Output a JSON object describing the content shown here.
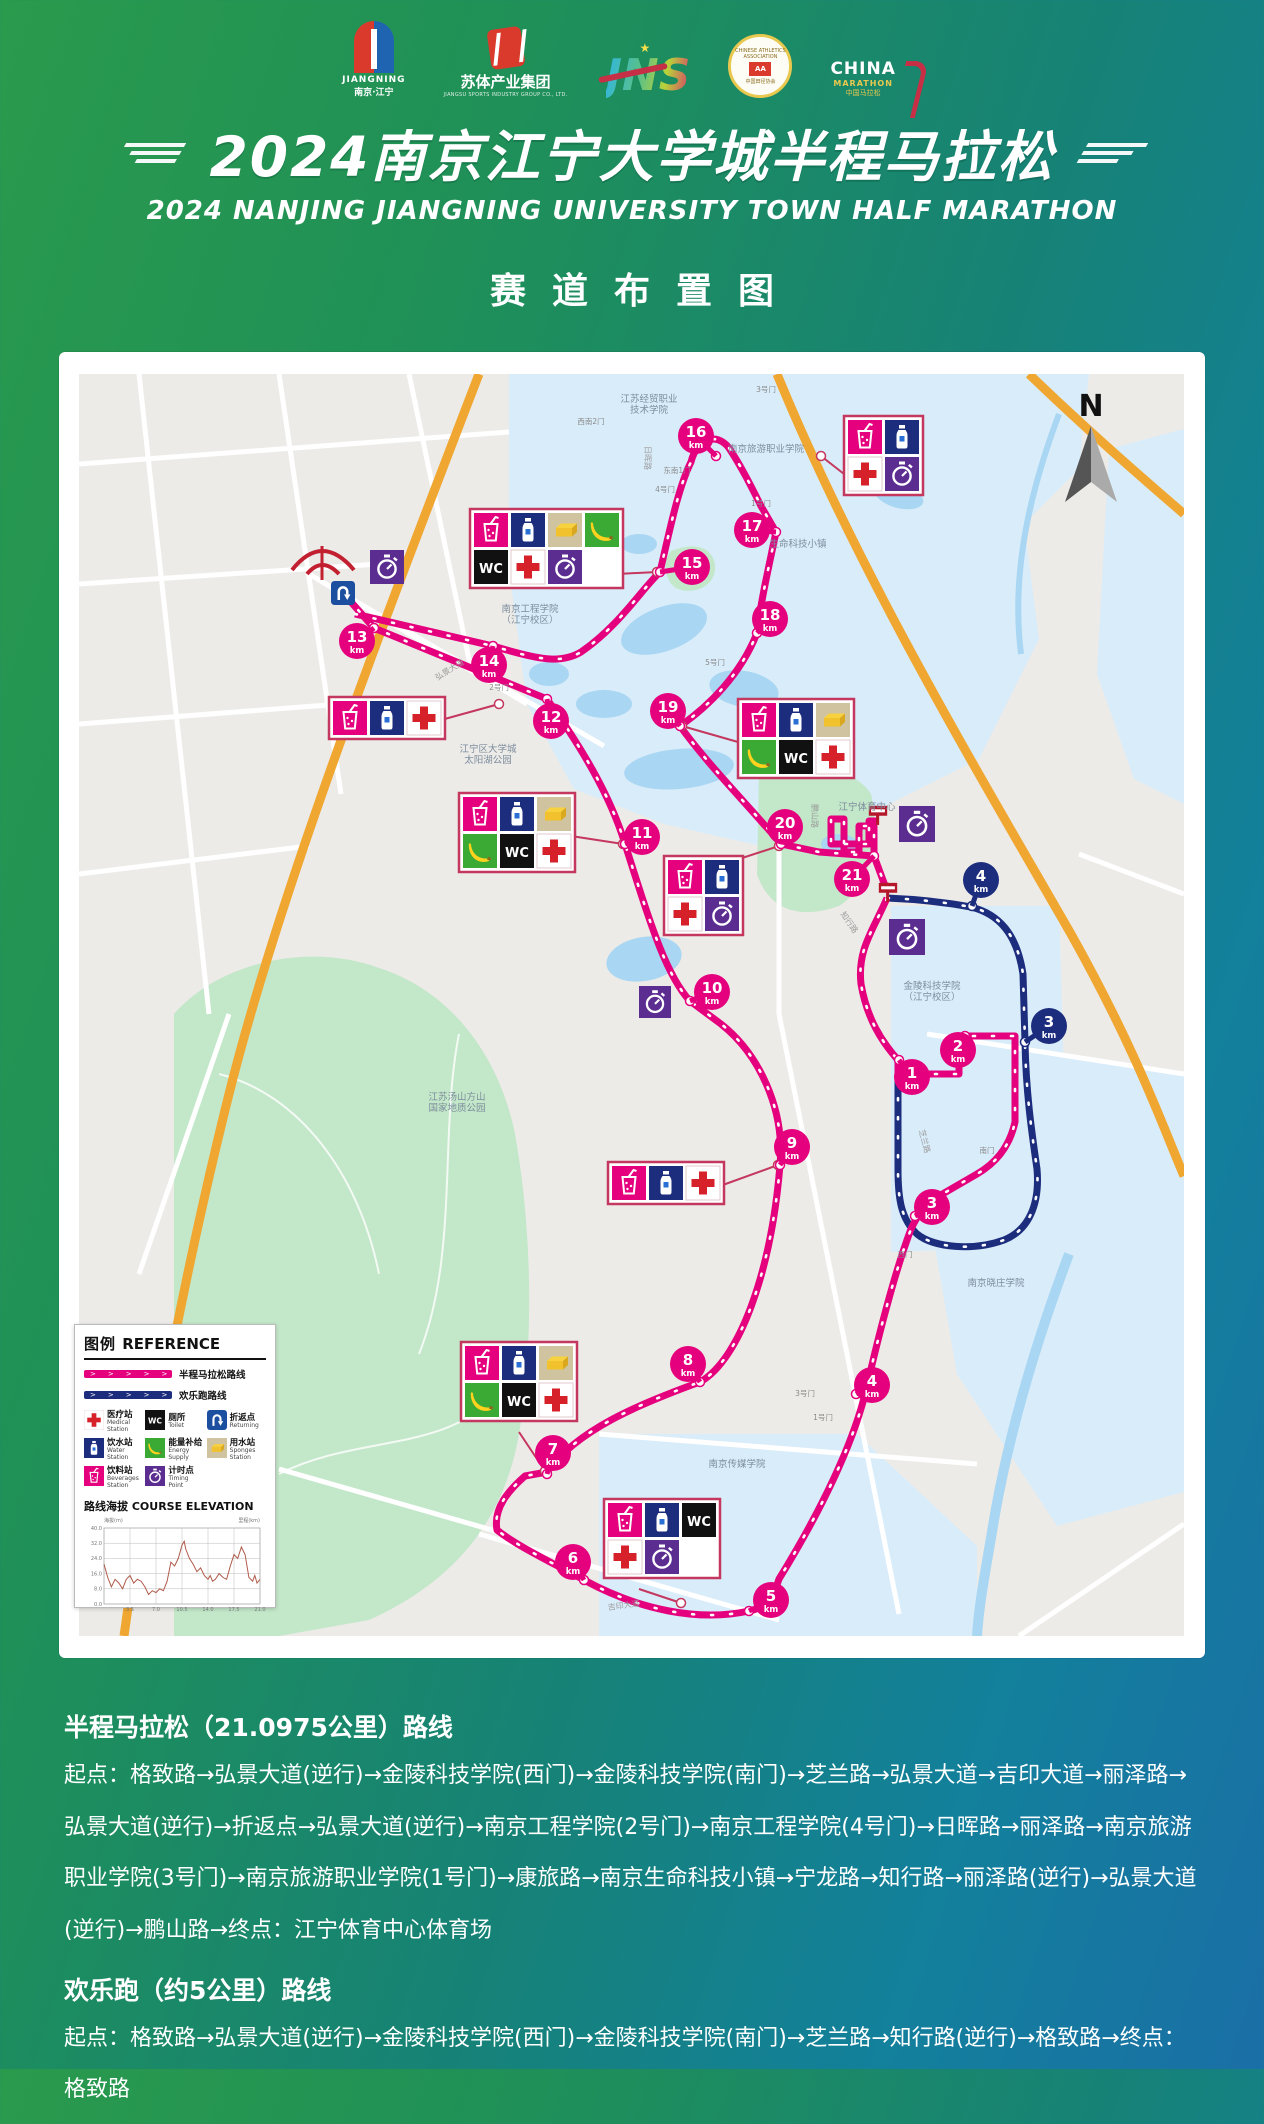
{
  "header": {
    "logos": {
      "jiangning": {
        "en": "JIANGNING",
        "zh": "南京·江宁"
      },
      "sutí": {
        "name": "苏体产业集团",
        "sub": "JIANGSU SPORTS INDUSTRY GROUP CO., LTD."
      },
      "jns": {
        "name": "JNS"
      },
      "caa": {
        "ring_top": "CHINESE ATHLETICS ASSOCIATION",
        "center": "AA",
        "ring_bottom": "中国田径协会"
      },
      "china_marathon": {
        "l1": "CHINA",
        "l2": "MARATHON",
        "l3": "中国马拉松"
      }
    },
    "title_zh": "2024南京江宁大学城半程马拉松",
    "title_en": "2024 NANJING JIANGNING UNIVERSITY TOWN HALF MARATHON",
    "subtitle": "赛道布置图"
  },
  "map": {
    "north": "N",
    "colors": {
      "half": "#e5017d",
      "fun": "#1d2d7d",
      "park": "#c3e7c9",
      "water": "#a9d6f2",
      "campus": "#d9ecfa",
      "road": "#f0a732",
      "base": "#ecebe8"
    },
    "km_markers": [
      {
        "n": "1",
        "km": "km",
        "c": "p",
        "x": 833,
        "y": 703,
        "dx": 820,
        "dy": 686
      },
      {
        "n": "2",
        "km": "km",
        "c": "p",
        "x": 879,
        "y": 676,
        "dx": 886,
        "dy": 662
      },
      {
        "n": "3",
        "km": "km",
        "c": "n",
        "x": 970,
        "y": 652,
        "dx": 946,
        "dy": 668
      },
      {
        "n": "4",
        "km": "km",
        "c": "n",
        "x": 902,
        "y": 506,
        "dx": 893,
        "dy": 532
      },
      {
        "n": "3",
        "km": "km",
        "c": "p",
        "x": 853,
        "y": 833,
        "dx": 836,
        "dy": 842
      },
      {
        "n": "4",
        "km": "km",
        "c": "p",
        "x": 793,
        "y": 1011,
        "dx": 777,
        "dy": 1020
      },
      {
        "n": "5",
        "km": "km",
        "c": "p",
        "x": 692,
        "y": 1226,
        "dx": 670,
        "dy": 1237
      },
      {
        "n": "6",
        "km": "km",
        "c": "p",
        "x": 494,
        "y": 1188,
        "dx": 505,
        "dy": 1206
      },
      {
        "n": "7",
        "km": "km",
        "c": "p",
        "x": 474,
        "y": 1079,
        "dx": 468,
        "dy": 1100
      },
      {
        "n": "8",
        "km": "km",
        "c": "p",
        "x": 609,
        "y": 990,
        "dx": 621,
        "dy": 1008
      },
      {
        "n": "9",
        "km": "km",
        "c": "p",
        "x": 713,
        "y": 773,
        "dx": 701,
        "dy": 791
      },
      {
        "n": "10",
        "km": "km",
        "c": "p",
        "x": 633,
        "y": 618,
        "dx": 611,
        "dy": 627
      },
      {
        "n": "11",
        "km": "km",
        "c": "p",
        "x": 563,
        "y": 463,
        "dx": 546,
        "dy": 470
      },
      {
        "n": "12",
        "km": "km",
        "c": "p",
        "x": 472,
        "y": 347,
        "dx": 468,
        "dy": 325
      },
      {
        "n": "13",
        "km": "km",
        "c": "p",
        "x": 278,
        "y": 267,
        "dx": 295,
        "dy": 254
      },
      {
        "n": "14",
        "km": "km",
        "c": "p",
        "x": 410,
        "y": 291,
        "dx": 414,
        "dy": 272
      },
      {
        "n": "15",
        "km": "km",
        "c": "p",
        "x": 613,
        "y": 193,
        "dx": 581,
        "dy": 198
      },
      {
        "n": "16",
        "km": "km",
        "c": "p",
        "x": 617,
        "y": 62,
        "dx": 637,
        "dy": 82
      },
      {
        "n": "17",
        "km": "km",
        "c": "p",
        "x": 673,
        "y": 156,
        "dx": 697,
        "dy": 158
      },
      {
        "n": "18",
        "km": "km",
        "c": "p",
        "x": 691,
        "y": 245,
        "dx": 678,
        "dy": 259
      },
      {
        "n": "19",
        "km": "km",
        "c": "p",
        "x": 589,
        "y": 337,
        "dx": 601,
        "dy": 352
      },
      {
        "n": "20",
        "km": "km",
        "c": "p",
        "x": 706,
        "y": 453,
        "dx": 702,
        "dy": 470
      },
      {
        "n": "21",
        "km": "km",
        "c": "p",
        "x": 773,
        "y": 505,
        "dx": 795,
        "dy": 482
      }
    ],
    "stations": [
      {
        "x": 765,
        "y": 42,
        "cols": 2,
        "icons": [
          "cup",
          "bottle",
          "cross",
          "timer"
        ],
        "line": [
          765,
          100,
          742,
          82
        ]
      },
      {
        "x": 391,
        "y": 135,
        "cols": 4,
        "icons": [
          "cup",
          "bottle",
          "sponge",
          "banana",
          "wc",
          "cross",
          "timer"
        ],
        "line": [
          538,
          200,
          578,
          198
        ]
      },
      {
        "x": 250,
        "y": 323,
        "cols": 3,
        "icons": [
          "cup",
          "bottle",
          "cross"
        ],
        "line": [
          362,
          346,
          420,
          330
        ]
      },
      {
        "x": 659,
        "y": 325,
        "cols": 3,
        "icons": [
          "cup",
          "bottle",
          "sponge",
          "banana",
          "wc",
          "cross"
        ],
        "line": [
          659,
          368,
          603,
          352
        ]
      },
      {
        "x": 380,
        "y": 419,
        "cols": 3,
        "icons": [
          "cup",
          "bottle",
          "sponge",
          "banana",
          "wc",
          "cross"
        ],
        "line": [
          492,
          462,
          544,
          470
        ]
      },
      {
        "x": 585,
        "y": 482,
        "cols": 2,
        "icons": [
          "cup",
          "bottle",
          "cross",
          "timer"
        ],
        "line": [
          657,
          486,
          700,
          472
        ]
      },
      {
        "x": 529,
        "y": 788,
        "cols": 3,
        "icons": [
          "cup",
          "bottle",
          "cross"
        ],
        "line": [
          641,
          812,
          699,
          791
        ]
      },
      {
        "x": 382,
        "y": 968,
        "cols": 3,
        "icons": [
          "cup",
          "bottle",
          "sponge",
          "banana",
          "wc",
          "cross"
        ],
        "line": [
          440,
          1058,
          466,
          1097
        ]
      },
      {
        "x": 525,
        "y": 1125,
        "cols": 3,
        "icons": [
          "cup",
          "bottle",
          "wc",
          "cross",
          "timer"
        ],
        "line": [
          560,
          1215,
          602,
          1229
        ]
      }
    ],
    "loose_icons": [
      {
        "type": "timer",
        "x": 291,
        "y": 176,
        "s": 34
      },
      {
        "type": "uturn",
        "x": 252,
        "y": 207,
        "s": 24
      },
      {
        "type": "timer",
        "x": 560,
        "y": 612,
        "s": 32
      },
      {
        "type": "flag",
        "x": 786,
        "y": 428,
        "s": 26
      },
      {
        "type": "timer",
        "x": 820,
        "y": 432,
        "s": 36
      },
      {
        "type": "flag",
        "x": 796,
        "y": 505,
        "s": 26
      },
      {
        "type": "timer",
        "x": 810,
        "y": 545,
        "s": 36
      }
    ],
    "labels": [
      {
        "t": "江苏经贸职业|技术学院",
        "x": 570,
        "y": 28
      },
      {
        "t": "南京旅游职业学院",
        "x": 687,
        "y": 78
      },
      {
        "t": "生命科技小镇",
        "x": 719,
        "y": 173
      },
      {
        "t": "南京工程学院|（江宁校区）",
        "x": 451,
        "y": 238
      },
      {
        "t": "江宁区大学城|太阳湖公园",
        "x": 409,
        "y": 378
      },
      {
        "t": "江宁体育中心",
        "x": 788,
        "y": 436
      },
      {
        "t": "金陵科技学院|（江宁校区）",
        "x": 853,
        "y": 615
      },
      {
        "t": "江苏汤山方山|国家地质公园",
        "x": 378,
        "y": 726
      },
      {
        "t": "南京晓庄学院",
        "x": 917,
        "y": 912
      },
      {
        "t": "南京传媒学院",
        "x": 658,
        "y": 1093
      }
    ],
    "gates": [
      {
        "t": "3号门",
        "x": 687,
        "y": 18
      },
      {
        "t": "西南2门",
        "x": 512,
        "y": 50
      },
      {
        "t": "东南1门",
        "x": 598,
        "y": 99
      },
      {
        "t": "4号门",
        "x": 586,
        "y": 118
      },
      {
        "t": "1号门",
        "x": 682,
        "y": 132
      },
      {
        "t": "5号门",
        "x": 636,
        "y": 291
      },
      {
        "t": "2号门",
        "x": 420,
        "y": 316
      },
      {
        "t": "西门",
        "x": 826,
        "y": 883
      },
      {
        "t": "南门",
        "x": 908,
        "y": 779
      },
      {
        "t": "3号门",
        "x": 726,
        "y": 1022
      },
      {
        "t": "1号门",
        "x": 744,
        "y": 1046
      }
    ],
    "roads": [
      {
        "t": "日晖路",
        "x": 566,
        "y": 84,
        "r": 90
      },
      {
        "t": "弘景大道",
        "x": 372,
        "y": 298,
        "r": -32
      },
      {
        "t": "鹏山路",
        "x": 733,
        "y": 442,
        "r": 90
      },
      {
        "t": "知行路",
        "x": 768,
        "y": 550,
        "r": 55
      },
      {
        "t": "芝兰路",
        "x": 843,
        "y": 768,
        "r": 75
      },
      {
        "t": "吉印大道",
        "x": 545,
        "y": 1234,
        "r": -8
      }
    ]
  },
  "legend": {
    "title_zh": "图例",
    "title_en": "REFERENCE",
    "route_lines": [
      {
        "label": "半程马拉松路线",
        "color": "#e5017d"
      },
      {
        "label": "欢乐跑路线",
        "color": "#1d2d7d"
      }
    ],
    "items": [
      {
        "icon": "cross",
        "zh": "医疗站",
        "en": "Medical Station"
      },
      {
        "icon": "wc",
        "zh": "厕所",
        "en": "Toilet"
      },
      {
        "icon": "uturn",
        "zh": "折返点",
        "en": "Returning"
      },
      {
        "icon": "bottle",
        "zh": "饮水站",
        "en": "Water Station"
      },
      {
        "icon": "banana",
        "zh": "能量补给",
        "en": "Energy Supply"
      },
      {
        "icon": "sponge",
        "zh": "用水站",
        "en": "Sponges Station"
      },
      {
        "icon": "cup",
        "zh": "饮料站",
        "en": "Beverages Station"
      },
      {
        "icon": "timer",
        "zh": "计时点",
        "en": "Timing Point"
      }
    ],
    "elevation_title_zh": "路线海拔",
    "elevation_title_en": "COURSE ELEVATION",
    "axis_left": "海拔(m)",
    "axis_right": "里程(km)"
  },
  "chart_data": {
    "type": "line",
    "title": "路线海拔 COURSE ELEVATION",
    "xlabel": "里程(km)",
    "ylabel": "海拔(m)",
    "xlim": [
      0,
      21
    ],
    "ylim": [
      0,
      40
    ],
    "x_ticks": [
      3.5,
      7.0,
      10.5,
      14.0,
      17.5,
      21.0
    ],
    "y_ticks": [
      0.0,
      8.0,
      16.0,
      24.0,
      32.0,
      40.0
    ],
    "x": [
      0,
      0.5,
      1,
      1.5,
      2,
      2.5,
      3,
      3.5,
      4,
      4.5,
      5,
      5.5,
      6,
      6.5,
      7,
      7.5,
      8,
      8.5,
      9,
      9.5,
      10,
      10.5,
      10.8,
      11,
      11.5,
      12,
      12.5,
      13,
      13.5,
      14,
      14.3,
      14.6,
      15,
      15.5,
      16,
      16.5,
      17,
      17.5,
      18,
      18.5,
      19,
      19.5,
      20,
      20.3,
      20.6,
      21
    ],
    "y": [
      21,
      14,
      9,
      13,
      11,
      8,
      13,
      15,
      11,
      13,
      12,
      9,
      5,
      7,
      6,
      8,
      7,
      12,
      22,
      20,
      24,
      31,
      33,
      29,
      24,
      21,
      17,
      19,
      15,
      13,
      15,
      12,
      13,
      16,
      14,
      13,
      20,
      26,
      24,
      30,
      26,
      14,
      12,
      15,
      11,
      13
    ]
  },
  "routes_text": {
    "half": {
      "heading": "半程马拉松（21.0975公里）路线",
      "body": "起点：格致路→弘景大道(逆行)→金陵科技学院(西门)→金陵科技学院(南门)→芝兰路→弘景大道→吉印大道→丽泽路→弘景大道(逆行)→折返点→弘景大道(逆行)→南京工程学院(2号门)→南京工程学院(4号门)→日晖路→丽泽路→南京旅游职业学院(3号门)→南京旅游职业学院(1号门)→康旅路→南京生命科技小镇→宁龙路→知行路→丽泽路(逆行)→弘景大道(逆行)→鹏山路→终点：江宁体育中心体育场"
    },
    "fun": {
      "heading": "欢乐跑（约5公里）路线",
      "body": "起点：格致路→弘景大道(逆行)→金陵科技学院(西门)→金陵科技学院(南门)→芝兰路→知行路(逆行)→格致路→终点：格致路"
    }
  }
}
